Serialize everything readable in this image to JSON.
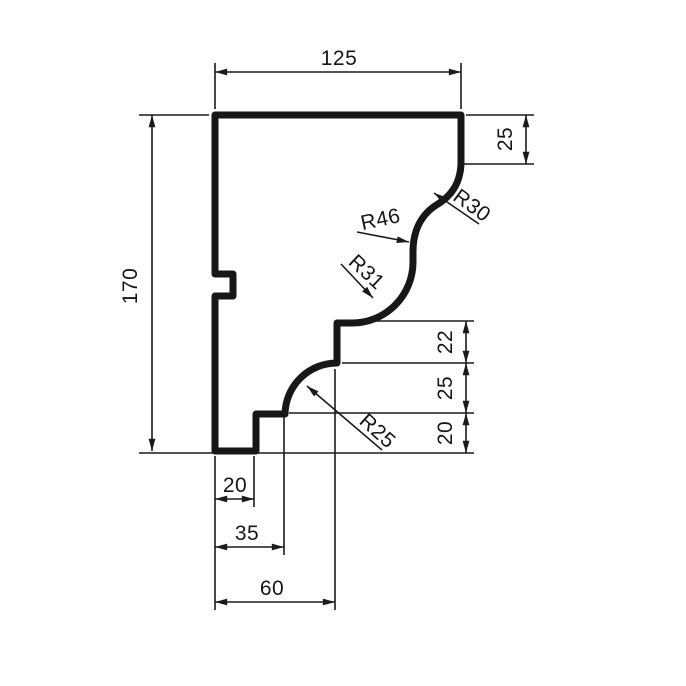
{
  "drawing": {
    "title": "molding-profile-section",
    "background_color": "#ffffff",
    "line_color": "#1a1a1a",
    "dim_top": {
      "value": "125"
    },
    "dim_left": {
      "value": "170"
    },
    "dim_right_top": {
      "value": "25"
    },
    "dim_right_stack": {
      "r1": "22",
      "r2": "25",
      "r3": "20"
    },
    "dim_bottom_stack": {
      "b1": "20",
      "b2": "35",
      "b3": "60"
    },
    "radius_labels": {
      "r30": "R30",
      "r46": "R46",
      "r31": "R31",
      "r25": "R25"
    }
  }
}
